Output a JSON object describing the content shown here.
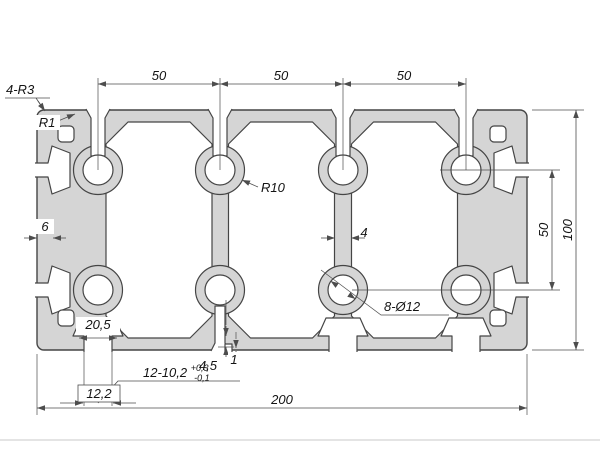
{
  "drawing": {
    "colors": {
      "bg": "#ffffff",
      "profile_fill": "#d5d5d5",
      "outline": "#454545",
      "dim": "#4d4d4d",
      "text": "#141414"
    },
    "top_chain": {
      "seg1": "50",
      "seg2": "50",
      "seg3": "50"
    },
    "right": {
      "inner": "50",
      "overall": "100"
    },
    "bottom": {
      "overall": "200",
      "slot_inner_width": "20,5",
      "slot_spec": "12-10,2",
      "slot_spec_sup": "+0,3",
      "slot_spec_sub": "-0,1",
      "slot_opening": "12,2",
      "slot_depth": "4,5",
      "slot_lip": "1"
    },
    "walls": {
      "outer": "6",
      "web": "4"
    },
    "radii": {
      "corners": "4-R3",
      "lip": "R1",
      "core": "R10"
    },
    "holes": {
      "callout": "8-Ø12"
    }
  }
}
